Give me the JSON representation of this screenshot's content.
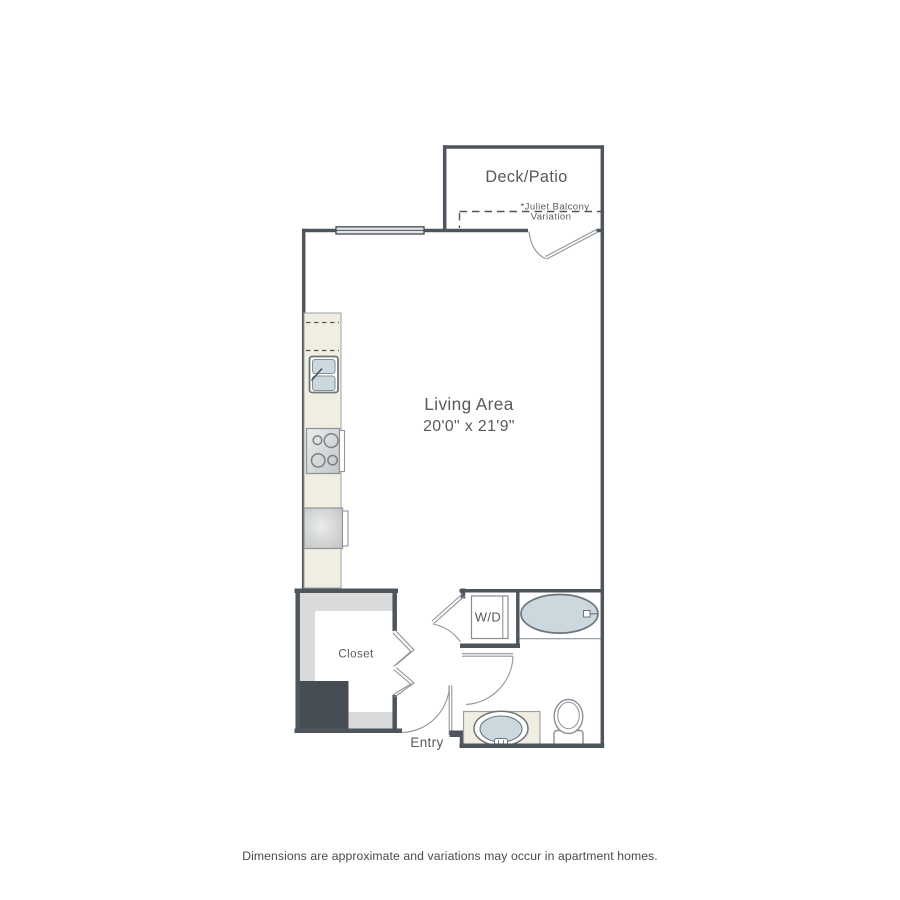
{
  "floor_plan": {
    "rooms": {
      "deck_patio": {
        "label": "Deck/Patio"
      },
      "juliet_note": {
        "line1": "*Juliet Balcony",
        "line2": "Variation"
      },
      "living_area": {
        "label": "Living Area",
        "dimensions": "20'0\" x 21'9\""
      },
      "closet": {
        "label": "Closet"
      },
      "laundry": {
        "label": "W/D"
      },
      "entry": {
        "label": "Entry"
      }
    },
    "footer": "Dimensions are approximate and variations may occur in apartment homes.",
    "colors": {
      "wall": "#4E555C",
      "thin_line": "#8E959B",
      "counter": "#F0EEE0",
      "fixture_fill": "#CBD8DD",
      "closet_shelf": "#DADADA",
      "column": "#474D54",
      "appliance": "#C9CACB",
      "label_text": "#58595B"
    }
  }
}
